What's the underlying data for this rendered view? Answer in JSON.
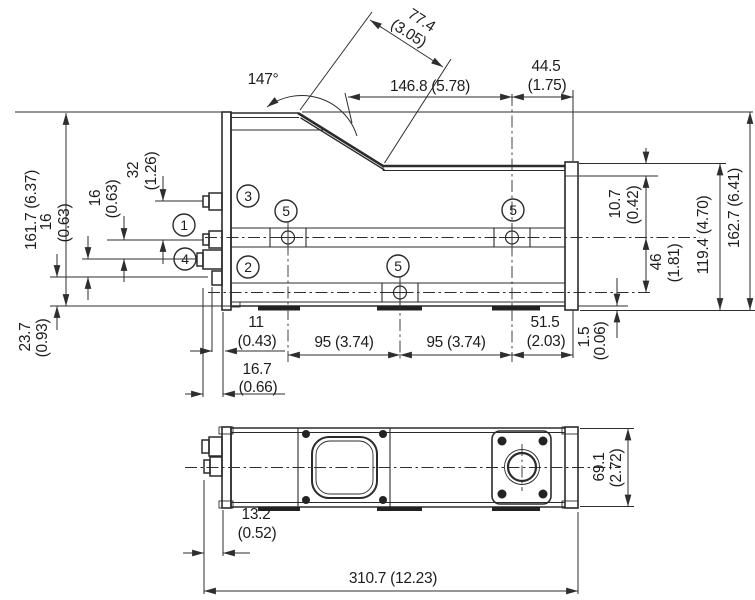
{
  "drawing": {
    "type": "technical dimensional drawing, side view and bottom view of sensor housing",
    "ink_color": "#2b2b2b",
    "background": "#ffffff"
  },
  "dims": {
    "d_slant": {
      "mm": "77.4",
      "inch": "(3.05)"
    },
    "d_angle": "147°",
    "d_1468": "146.8 (5.78)",
    "d_445": {
      "mm": "44.5",
      "inch": "(1.75)"
    },
    "d_1617": "161.7 (6.37)",
    "d_32": {
      "mm": "32",
      "inch": "(1.26)"
    },
    "d_16a": {
      "mm": "16",
      "inch": "(0.63)"
    },
    "d_16b": {
      "mm": "16",
      "inch": "(0.63)"
    },
    "d_237": {
      "mm": "23.7",
      "inch": "(0.93)"
    },
    "d_107": {
      "mm": "10.7",
      "inch": "(0.42)"
    },
    "d_46": {
      "mm": "46",
      "inch": "(1.81)"
    },
    "d_1194": "119.4 (4.70)",
    "d_1627": "162.7 (6.41)",
    "d_15": {
      "mm": "1.5",
      "inch": "(0.06)"
    },
    "d_11": {
      "mm": "11",
      "inch": "(0.43)"
    },
    "d_167": {
      "mm": "16.7",
      "inch": "(0.66)"
    },
    "d_95a": "95 (3.74)",
    "d_95b": "95 (3.74)",
    "d_515": {
      "mm": "51.5",
      "inch": "(2.03)"
    },
    "d_132": {
      "mm": "13.2",
      "inch": "(0.52)"
    },
    "d_3107": "310.7 (12.23)",
    "d_691": {
      "mm": "69.1",
      "inch": "(2.72)"
    }
  },
  "callouts": {
    "c1": "1",
    "c2": "2",
    "c3": "3",
    "c4": "4",
    "c5": "5"
  }
}
